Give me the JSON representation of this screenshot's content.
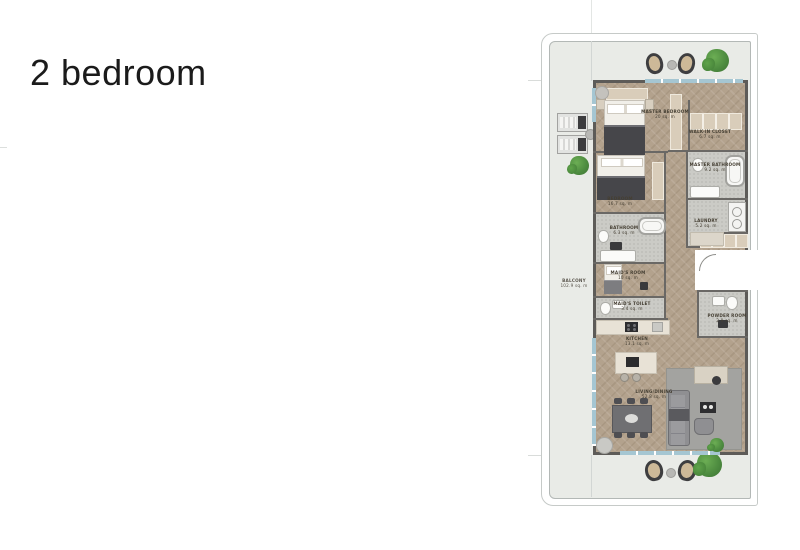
{
  "page": {
    "title": "2 bedroom"
  },
  "floorplan": {
    "label": "2-bedroom apartment floor plan with wrap-around balcony",
    "rooms": [
      {
        "name": "MASTER BEDROOM",
        "area": "20 sq. m"
      },
      {
        "name": "WALK-IN CLOSET",
        "area": "6.7 sq. m"
      },
      {
        "name": "MASTER BATHROOM",
        "area": "9.2 sq. m"
      },
      {
        "name": "BEDROOM",
        "area": "16.7 sq. m"
      },
      {
        "name": "LAUNDRY",
        "area": "5.2 sq. m"
      },
      {
        "name": "BATHROOM",
        "area": "6.3 sq. m"
      },
      {
        "name": "MAID'S ROOM",
        "area": "10 sq. m"
      },
      {
        "name": "MAID'S TOILET",
        "area": "3.4 sq. m"
      },
      {
        "name": "POWDER ROOM",
        "area": "2.9 sq. m"
      },
      {
        "name": "KITCHEN",
        "area": "13.1 sq. m"
      },
      {
        "name": "LIVING/DINING",
        "area": "52.8 sq. m"
      },
      {
        "name": "BALCONY",
        "area": "102.9 sq. m"
      }
    ],
    "palette": {
      "wood_floor": "#b3a28d",
      "wall": "#5d5b58",
      "balcony_slab": "#e9ebe7",
      "window": "#a5c6d2",
      "tile": "#cbcbc6",
      "rug": "#a3a3a0",
      "plant": "#5a9a4c",
      "cabinetry": "#d9cdba"
    }
  }
}
